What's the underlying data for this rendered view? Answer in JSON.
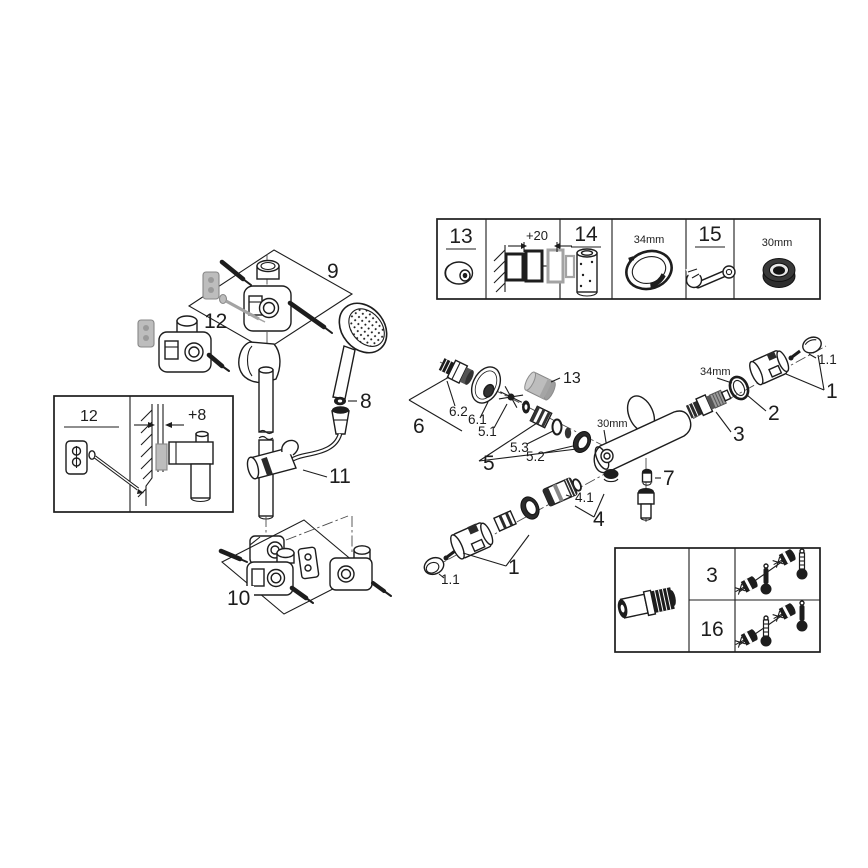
{
  "canvas": {
    "background": "#ffffff",
    "line_color": "#1d1d1d",
    "gray_part_color": "#bdbdbd"
  },
  "top_parts_table": {
    "tool_13": "13",
    "depth_dim": "+20",
    "extension_14": "14",
    "ring_dim": "34mm",
    "wrench_15": "15",
    "nut_dim": "30mm"
  },
  "rail_assembly": {
    "top_bracket_group": "9",
    "plug_screw_set": "12",
    "hose_gasket": "8",
    "glide_holder": "11",
    "bottom_bracket_group": "10"
  },
  "mount_detail_box": {
    "plug_screw_set": "12",
    "offset_dim": "+8"
  },
  "thermostat_assembly": {
    "cap_tool": "13",
    "s_union": "6.2",
    "escutcheon": "6.1",
    "s_union_group": "6",
    "insert": "5.1",
    "o_ring": "5.3",
    "nut": "5.2",
    "union_group": "5",
    "body_nut_dim": "30mm",
    "cartridge_nut_dim": "34mm",
    "stop_ring": "2",
    "cartridge": "3",
    "handle_right": "1",
    "handle_cap_right": "1.1",
    "screw_plug": "7",
    "thermo_cartridge": "4.1",
    "thermo_group": "4",
    "handle_left": "1",
    "handle_cap_left": "1.1"
  },
  "variant_table": {
    "rows": [
      {
        "part": "3"
      },
      {
        "part": "16"
      }
    ]
  }
}
